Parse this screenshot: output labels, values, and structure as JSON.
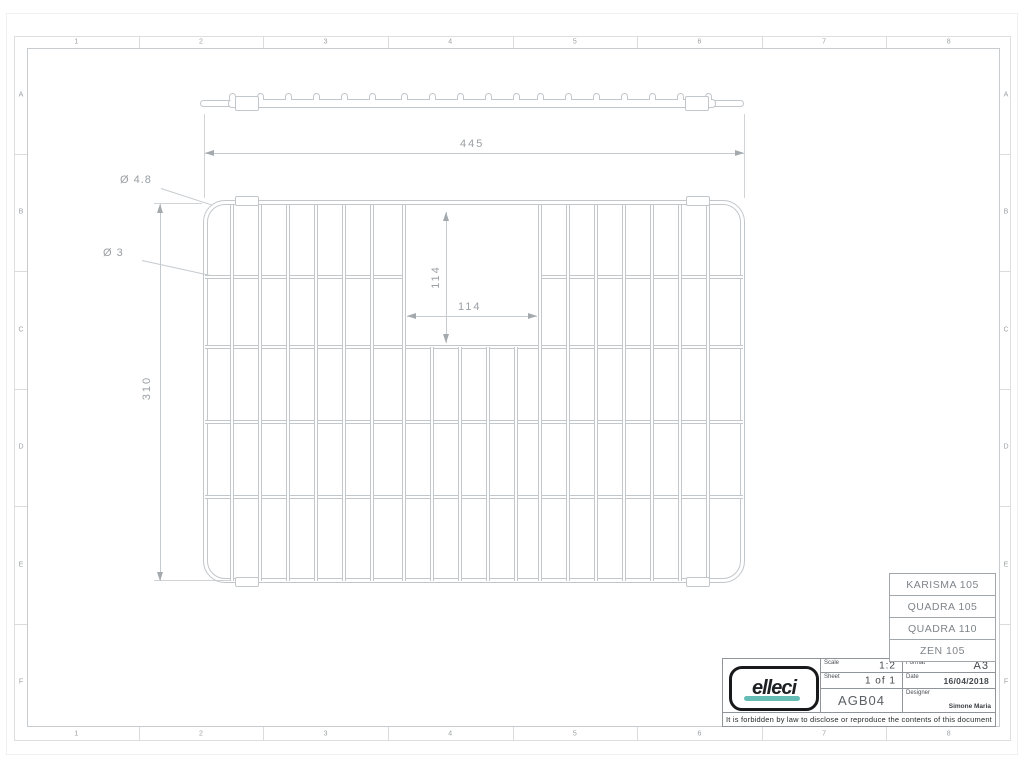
{
  "border": {
    "column_labels": [
      "1",
      "2",
      "3",
      "4",
      "5",
      "6",
      "7",
      "8"
    ],
    "row_labels": [
      "A",
      "B",
      "C",
      "D",
      "E",
      "F"
    ]
  },
  "dimensions": {
    "overall_width": "445",
    "overall_height": "310",
    "opening_width": "114",
    "opening_height": "114",
    "frame_wire_diameter": "Ø 4.8",
    "grid_wire_diameter": "Ø 3"
  },
  "compatible_models": [
    "KARISMA 105",
    "QUADRA 105",
    "QUADRA 110",
    "ZEN 105"
  ],
  "title_block": {
    "logo_text": "elleci",
    "scale_label": "Scale",
    "scale_value": "1:2",
    "sheet_label": "Sheet",
    "sheet_value": "1 of 1",
    "format_label": "Format",
    "format_value": "A3",
    "date_label": "Date",
    "date_value": "16/04/2018",
    "drawing_code": "AGB04",
    "designer_label": "Designer",
    "designer_value": "Simone Maria",
    "disclaimer": "It is forbidden by law to disclose or reproduce the contents of this document"
  },
  "colors": {
    "wire_line": "#c2c7cb",
    "dim_text": "#9aa0a5",
    "logo_teal": "#66bdb6"
  }
}
